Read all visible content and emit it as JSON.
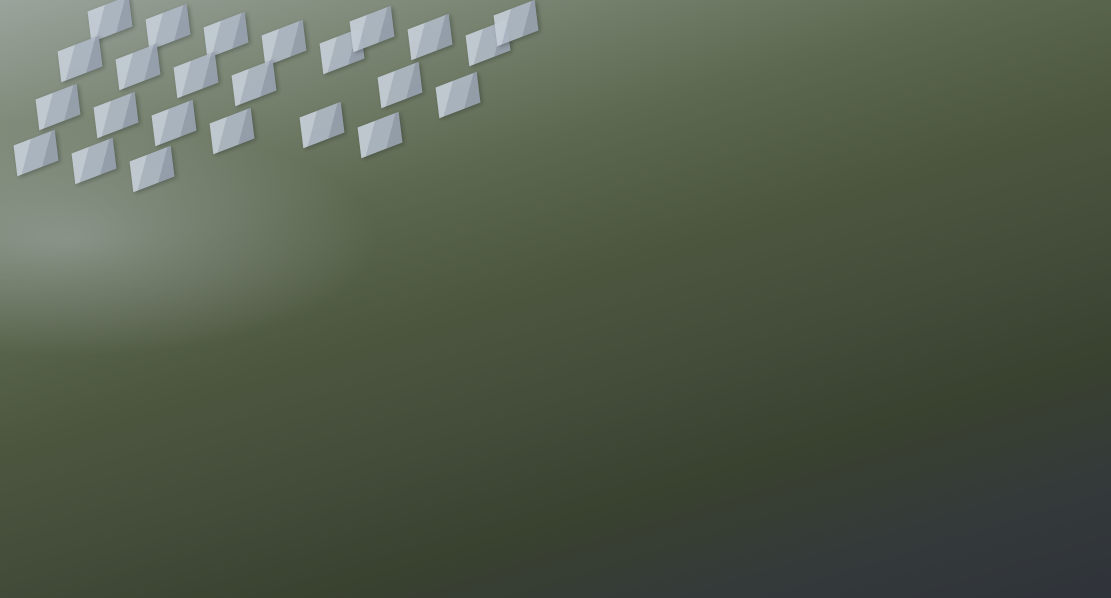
{
  "meta": {
    "description": "Aerial dusk architectural rendering of a residential development: white high-rise towers and mid-rise slab buildings around a central landscaped courtyard with blue swimming pool and golden autumn trees, a glass-roofed sales center at the lower right street corner, hazy gray context towers and massing blocks in the surroundings, dark low-rise neighborhood in the foreground, black letterbox frame"
  },
  "palette": {
    "frame": "#000000",
    "context_block": "#aeb8c4",
    "context_tower": "#8f9aa8",
    "tower_face_light": "#e9ecef",
    "tower_face_dark": "#72839b",
    "tower_roof_deck": "#5a6d88",
    "tower_roof_trim": "#d7dde4",
    "slab_roof": "#b3c0cd",
    "slab_trim": "#e8edf2",
    "slab_face": "#7b899e",
    "lawn": "#72814f",
    "pool_water": "#3e68a8",
    "pool_deck": "#9aa2a7",
    "tree_dark": "#36432e",
    "tree_gold": "#d4a74c",
    "road_light": "#878f97",
    "road_dark": "#50545e",
    "road_main": "#5d626b",
    "lane_yellow": "#c7b04e",
    "crosswalk": "#dfe3e7",
    "glass_roof": "#6e8396",
    "bus_blue": "#4a7fc1",
    "bus_white": "#ccd2d8",
    "car_blue": "#5577aa",
    "car_dark": "#3a4048",
    "flower_pink": "#d98aa0"
  },
  "scene": {
    "frame": {
      "top": 5,
      "right": 5,
      "bottom": 16,
      "left": 3
    },
    "background_blocks": [
      [
        88,
        4
      ],
      [
        146,
        12
      ],
      [
        204,
        20
      ],
      [
        262,
        28
      ],
      [
        320,
        36
      ],
      [
        58,
        44
      ],
      [
        116,
        52
      ],
      [
        174,
        60
      ],
      [
        232,
        68
      ],
      [
        36,
        92
      ],
      [
        94,
        100
      ],
      [
        152,
        108
      ],
      [
        210,
        116
      ],
      [
        14,
        138
      ],
      [
        72,
        146
      ],
      [
        130,
        154
      ],
      [
        350,
        14
      ],
      [
        408,
        22
      ],
      [
        466,
        28
      ],
      [
        378,
        70
      ],
      [
        436,
        80
      ],
      [
        300,
        110
      ],
      [
        358,
        120
      ],
      [
        494,
        8
      ]
    ],
    "background_towers": [
      [
        744,
        24,
        64,
        170
      ],
      [
        818,
        4,
        92,
        205
      ],
      [
        948,
        0,
        84,
        130
      ],
      [
        984,
        56,
        86,
        155
      ],
      [
        1066,
        0,
        44,
        90
      ],
      [
        1008,
        148,
        64,
        175
      ],
      [
        1060,
        206,
        51,
        215
      ],
      [
        874,
        128,
        60,
        125
      ],
      [
        690,
        0,
        48,
        110
      ],
      [
        0,
        192,
        72,
        145
      ]
    ],
    "roads": [
      [
        -10,
        368,
        660,
        20,
        -25.5,
        "light"
      ],
      [
        945,
        205,
        260,
        24,
        -40,
        "light"
      ],
      [
        92,
        2,
        305,
        9,
        51,
        "path"
      ],
      [
        110,
        462,
        850,
        26,
        10,
        "dark"
      ],
      [
        -10,
        512,
        600,
        20,
        9,
        "dark"
      ],
      [
        150,
        470,
        140,
        14,
        69,
        "dark"
      ],
      [
        40,
        482,
        150,
        13,
        69,
        "dark"
      ],
      [
        430,
        252,
        120,
        8,
        -21,
        "path"
      ],
      [
        618,
        242,
        110,
        8,
        -21,
        "path"
      ],
      [
        330,
        322,
        74,
        8,
        -21,
        "path"
      ],
      [
        905,
        520,
        150,
        70,
        -10,
        "junction"
      ],
      [
        998,
        394,
        44,
        220,
        10,
        "main"
      ],
      [
        1008,
        505,
        120,
        28,
        -12,
        "east"
      ]
    ],
    "dark_blocks": [
      [
        48,
        458,
        132,
        36
      ],
      [
        186,
        490,
        148,
        38
      ],
      [
        338,
        514,
        148,
        38
      ],
      [
        492,
        540,
        146,
        36
      ],
      [
        14,
        516,
        108,
        34
      ],
      [
        146,
        548,
        136,
        32
      ],
      [
        296,
        572,
        126,
        26
      ],
      [
        636,
        556,
        118,
        32
      ],
      [
        0,
        468,
        44,
        32
      ],
      [
        418,
        580,
        120,
        18
      ]
    ],
    "trees_background": [
      [
        28,
        56,
        34
      ],
      [
        66,
        88,
        30
      ],
      [
        108,
        118,
        34
      ],
      [
        146,
        148,
        30
      ],
      [
        38,
        158,
        28
      ],
      [
        88,
        196,
        34
      ],
      [
        196,
        86,
        26
      ],
      [
        244,
        116,
        28
      ],
      [
        294,
        146,
        26
      ],
      [
        228,
        198,
        32
      ],
      [
        176,
        246,
        34
      ],
      [
        128,
        298,
        36
      ],
      [
        82,
        344,
        38
      ],
      [
        148,
        388,
        36
      ],
      [
        36,
        258,
        30
      ],
      [
        16,
        414,
        34
      ],
      [
        214,
        302,
        30
      ],
      [
        256,
        236,
        26
      ],
      [
        306,
        196,
        24
      ],
      [
        356,
        166,
        22
      ],
      [
        406,
        136,
        22
      ],
      [
        456,
        106,
        22
      ],
      [
        506,
        86,
        20
      ],
      [
        330,
        96,
        24
      ],
      [
        270,
        166,
        24
      ],
      [
        780,
        66,
        30
      ],
      [
        836,
        104,
        32
      ],
      [
        886,
        146,
        30
      ],
      [
        936,
        86,
        26
      ],
      [
        986,
        124,
        28
      ],
      [
        1036,
        166,
        30
      ],
      [
        944,
        206,
        30
      ],
      [
        992,
        256,
        32
      ],
      [
        1044,
        306,
        34
      ],
      [
        902,
        256,
        30
      ],
      [
        856,
        204,
        28
      ],
      [
        1072,
        386,
        34
      ],
      [
        1022,
        406,
        30
      ],
      [
        962,
        336,
        30
      ],
      [
        700,
        120,
        26
      ],
      [
        748,
        170,
        26
      ],
      [
        666,
        60,
        22
      ]
    ],
    "features": [
      {
        "kind": "pool-deck",
        "x": 438,
        "y": 248,
        "w": 214,
        "h": 132,
        "rot": -21
      },
      {
        "kind": "sunken-garden",
        "x": 500,
        "y": 320,
        "w": 76,
        "h": 48,
        "rot": -21
      },
      {
        "kind": "pool",
        "x": 474,
        "y": 268,
        "w": 142,
        "h": 80,
        "rot": -15
      },
      {
        "kind": "courtyard",
        "x": 522,
        "y": 156,
        "w": 106,
        "h": 86,
        "rot": -21
      },
      {
        "kind": "pool-pavilion",
        "x": 550,
        "y": 264,
        "w": 24,
        "h": 42,
        "rot": -21
      },
      {
        "kind": "sales-upper",
        "x": 884,
        "y": 384,
        "w": 58,
        "h": 46,
        "rot": -21
      },
      {
        "kind": "sales-main",
        "x": 880,
        "y": 408,
        "w": 126,
        "h": 148,
        "rot": -21
      },
      {
        "kind": "sales-annex",
        "x": 856,
        "y": 504,
        "w": 86,
        "h": 74,
        "rot": -21
      },
      {
        "kind": "sales-white",
        "x": 844,
        "y": 466,
        "w": 30,
        "h": 56,
        "rot": -21
      }
    ],
    "slabs": [
      [
        470,
        206,
        72,
        72,
        -21
      ],
      [
        578,
        220,
        74,
        66,
        -21
      ],
      [
        270,
        262,
        96,
        60,
        -21
      ],
      [
        374,
        286,
        138,
        60,
        -21
      ],
      [
        604,
        292,
        168,
        64,
        -21
      ],
      [
        826,
        336,
        118,
        56,
        -21
      ],
      [
        788,
        298,
        66,
        66,
        58
      ],
      [
        202,
        348,
        158,
        62,
        -21
      ],
      [
        374,
        386,
        138,
        58,
        -21
      ],
      [
        562,
        376,
        160,
        62,
        -21
      ],
      [
        744,
        398,
        150,
        60,
        -21
      ],
      [
        222,
        420,
        150,
        64,
        -21
      ],
      [
        400,
        440,
        165,
        64,
        -21
      ],
      [
        596,
        456,
        150,
        64,
        -21
      ]
    ],
    "towers": [
      [
        124,
        206,
        108,
        92
      ],
      [
        336,
        128,
        98,
        150
      ],
      [
        450,
        76,
        88,
        148
      ],
      [
        556,
        26,
        84,
        168
      ],
      [
        622,
        96,
        76,
        122
      ],
      [
        688,
        178,
        74,
        125
      ],
      [
        764,
        206,
        96,
        112
      ]
    ],
    "trees_foreground": [
      [
        300,
        330,
        24
      ],
      [
        424,
        312,
        22
      ],
      [
        482,
        382,
        24
      ],
      [
        560,
        422,
        24
      ],
      [
        642,
        362,
        22
      ],
      [
        722,
        342,
        22
      ],
      [
        762,
        432,
        24
      ],
      [
        842,
        382,
        24
      ],
      [
        602,
        262,
        20
      ],
      [
        662,
        312,
        22
      ],
      [
        262,
        302,
        22
      ],
      [
        232,
        392,
        24
      ],
      [
        332,
        432,
        24
      ],
      [
        502,
        432,
        22
      ],
      [
        582,
        482,
        24
      ],
      [
        662,
        502,
        24
      ],
      [
        540,
        332,
        18
      ],
      [
        250,
        500,
        30
      ],
      [
        350,
        532,
        28
      ],
      [
        450,
        562,
        26
      ],
      [
        550,
        572,
        24
      ],
      [
        650,
        556,
        26
      ],
      [
        150,
        540,
        30
      ],
      [
        60,
        560,
        30
      ],
      [
        755,
        520,
        26
      ],
      [
        822,
        560,
        26
      ],
      [
        180,
        470,
        26
      ],
      [
        90,
        480,
        28
      ],
      [
        910,
        470,
        24
      ],
      [
        964,
        414,
        24
      ],
      [
        996,
        458,
        24
      ],
      [
        934,
        566,
        24
      ],
      [
        1060,
        480,
        28
      ],
      [
        1096,
        520,
        26
      ],
      [
        876,
        236,
        22
      ],
      [
        920,
        300,
        24
      ],
      [
        952,
        362,
        26
      ],
      [
        870,
        420,
        22
      ],
      [
        118,
        444,
        26
      ],
      [
        20,
        500,
        28
      ],
      [
        590,
        530,
        24
      ],
      [
        694,
        540,
        22
      ]
    ],
    "trees_golden": [
      [
        520,
        176,
        12
      ],
      [
        508,
        202,
        11
      ],
      [
        504,
        228,
        12
      ],
      [
        636,
        206,
        12
      ],
      [
        646,
        232,
        11
      ],
      [
        600,
        154,
        10
      ],
      [
        568,
        148,
        10
      ],
      [
        470,
        256,
        12
      ],
      [
        448,
        276,
        12
      ],
      [
        628,
        268,
        12
      ],
      [
        656,
        294,
        12
      ],
      [
        498,
        360,
        12
      ],
      [
        528,
        370,
        12
      ],
      [
        558,
        378,
        11
      ],
      [
        420,
        346,
        12
      ],
      [
        392,
        358,
        11
      ],
      [
        362,
        348,
        11
      ],
      [
        700,
        390,
        12
      ],
      [
        730,
        402,
        11
      ],
      [
        820,
        302,
        11
      ],
      [
        850,
        312,
        10
      ],
      [
        878,
        432,
        11
      ],
      [
        898,
        452,
        10
      ],
      [
        756,
        462,
        11
      ],
      [
        688,
        482,
        11
      ],
      [
        426,
        392,
        10
      ],
      [
        452,
        402,
        10
      ],
      [
        926,
        480,
        10
      ],
      [
        944,
        500,
        10
      ],
      [
        930,
        520,
        9
      ],
      [
        944,
        540,
        9
      ],
      [
        912,
        554,
        9
      ],
      [
        440,
        160,
        10
      ],
      [
        412,
        180,
        10
      ]
    ],
    "vehicles": [
      [
        234,
        226,
        17,
        7,
        -25,
        "bus_blue"
      ],
      [
        976,
        430,
        8,
        20,
        10,
        "bus_white"
      ],
      [
        995,
        550,
        7,
        12,
        10,
        "car_blue"
      ],
      [
        1014,
        470,
        7,
        12,
        10,
        "car_dark"
      ]
    ],
    "pedestrians": [
      [
        963,
        516,
        "#c9566b"
      ],
      [
        970,
        524,
        "#e3e7ea"
      ],
      [
        978,
        534,
        "#caa05a"
      ],
      [
        984,
        544,
        "#c9566b"
      ],
      [
        958,
        508,
        "#e3e7ea"
      ]
    ],
    "flowers": [
      [
        952,
        498
      ],
      [
        942,
        516
      ],
      [
        950,
        532
      ],
      [
        938,
        548
      ],
      [
        958,
        544
      ]
    ]
  }
}
